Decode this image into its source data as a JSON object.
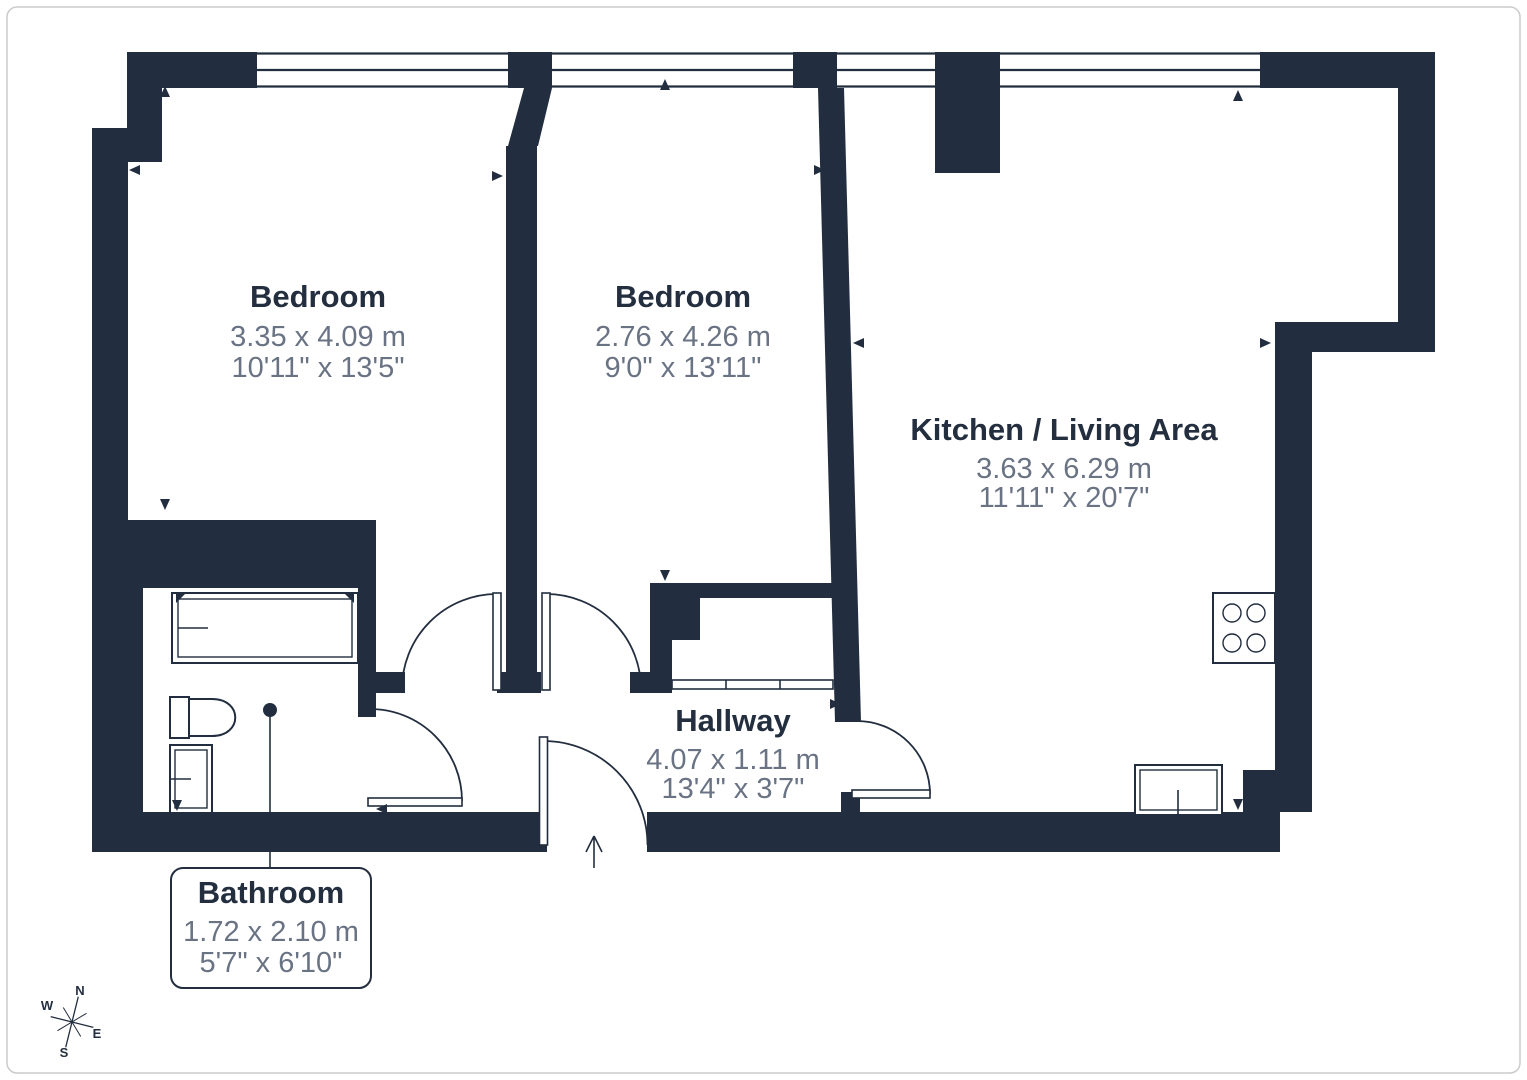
{
  "plan": {
    "title": "Apartment floor plan",
    "rooms": [
      {
        "name": "Bedroom",
        "dim_m": "3.35 x 4.09 m",
        "dim_ft": "10'11\" x 13'5\""
      },
      {
        "name": "Bedroom",
        "dim_m": "2.76 x 4.26 m",
        "dim_ft": "9'0\" x 13'11\""
      },
      {
        "name": "Kitchen / Living Area",
        "dim_m": "3.63 x 6.29 m",
        "dim_ft": "11'11\" x 20'7\""
      },
      {
        "name": "Hallway",
        "dim_m": "4.07 x 1.11 m",
        "dim_ft": "13'4\" x 3'7\""
      },
      {
        "name": "Bathroom",
        "dim_m": "1.72 x 2.10 m",
        "dim_ft": "5'7\" x 6'10\""
      }
    ],
    "compass": {
      "n": "N",
      "e": "E",
      "s": "S",
      "w": "W"
    },
    "colors": {
      "wall": "#222e3f",
      "dim_text": "#6a7384",
      "room_text": "#232e3f",
      "frame_border": "#cbcbcb",
      "background": "#ffffff"
    }
  }
}
